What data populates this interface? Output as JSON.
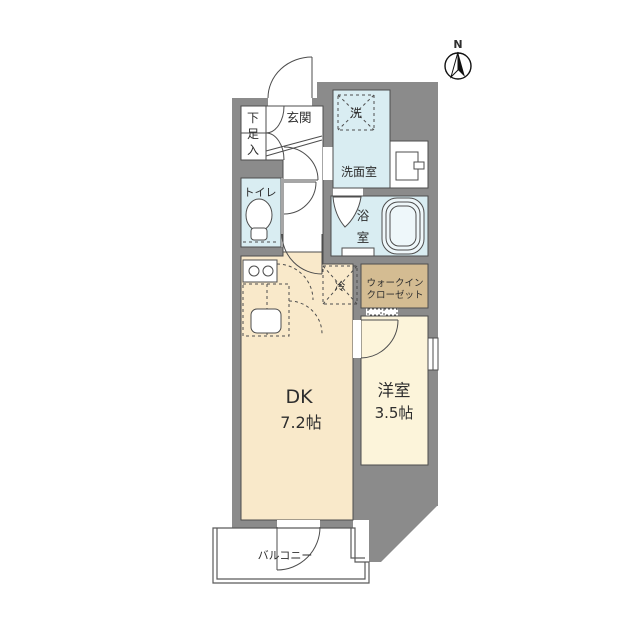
{
  "title": "apartment-floor-plan",
  "compass": {
    "north_label": "N"
  },
  "colors": {
    "wall": "#8b8b8b",
    "water_room": "#d9edf2",
    "dk_room": "#f9e9ca",
    "western_room": "#fcf4da",
    "closet": "#d4bc92",
    "outline": "#4d4d4d",
    "background": "#ffffff"
  },
  "rooms": {
    "genkan": {
      "label": "玄関"
    },
    "shoe_storage": {
      "label": "下足入",
      "chars": [
        "下",
        "足",
        "入"
      ]
    },
    "toilet": {
      "label": "トイレ"
    },
    "washroom": {
      "label": "洗面室"
    },
    "washer": {
      "label": "洗"
    },
    "bath": {
      "label": "浴室",
      "chars": [
        "浴",
        "室"
      ]
    },
    "fridge": {
      "label": "冷"
    },
    "walk_in_closet": {
      "label": "ウォークインクローゼット",
      "line1": "ウォークイン",
      "line2": "クローゼット"
    },
    "dk": {
      "label": "DK",
      "size": "7.2帖"
    },
    "western": {
      "label": "洋室",
      "size": "3.5帖"
    },
    "balcony": {
      "label": "バルコニー"
    }
  }
}
